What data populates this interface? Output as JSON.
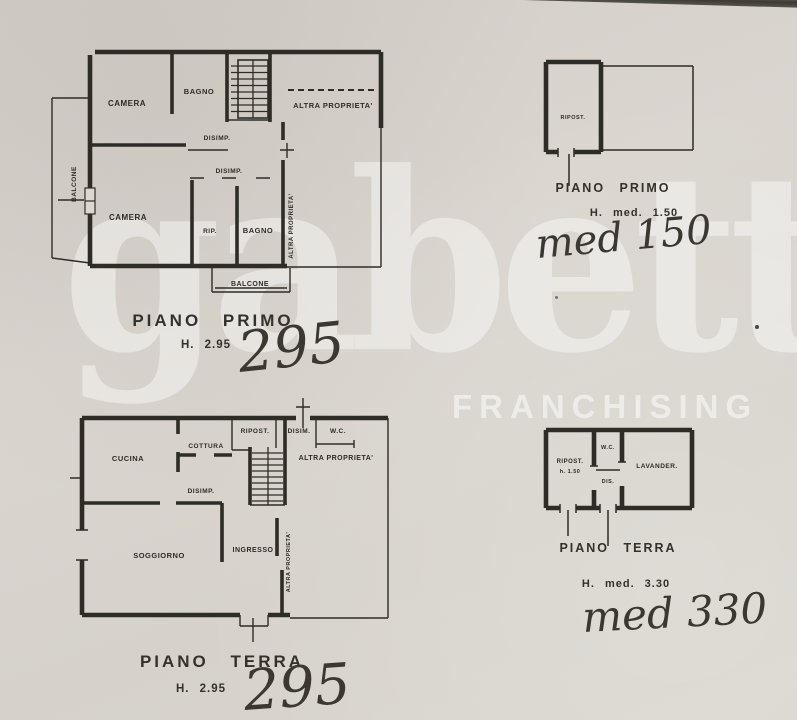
{
  "watermark": {
    "brand": "gabetti",
    "subtitle": "FRANCHISING"
  },
  "plan_piano_primo_main": {
    "rooms": {
      "camera_top": "CAMERA",
      "bagno_top": "BAGNO",
      "altra_proprieta_top": "ALTRA PROPRIETA'",
      "disimp_1": "DISIMP.",
      "disimp_2": "DISIMP.",
      "camera_bottom": "CAMERA",
      "ripostiglio": "RIP.",
      "bagno_bottom": "BAGNO",
      "altra_proprieta_side": "ALTRA PROPRIETA'",
      "balcone_left": "BALCONE",
      "balcone_bottom": "BALCONE"
    },
    "caption_title": "PIANO PRIMO",
    "caption_height": "H. 2.95",
    "handwritten_height": "295"
  },
  "plan_piano_primo_annex": {
    "rooms": {
      "ripostiglio": "RIPOST."
    },
    "caption_title": "PIANO PRIMO",
    "caption_height": "H. med. 1.50",
    "handwritten_height": "med 150"
  },
  "plan_piano_terra_main": {
    "rooms": {
      "cucina": "CUCINA",
      "cottura": "COTTURA",
      "ripostiglio": "RIPOST.",
      "disim": "DISIM.",
      "wc": "W.C.",
      "altra_proprieta_top": "ALTRA PROPRIETA'",
      "disimp": "DISIMP.",
      "soggiorno": "SOGGIORNO",
      "ingresso": "INGRESSO",
      "altra_proprieta_side": "ALTRA PROPRIETA'"
    },
    "caption_title": "PIANO TERRA",
    "caption_height": "H. 2.95",
    "handwritten_height": "295"
  },
  "plan_piano_terra_annex": {
    "rooms": {
      "ripostiglio": "RIPOST.",
      "ripostiglio_height": "h. 1.50",
      "wc": "W.C.",
      "dis": "DIS.",
      "lavanderia": "LAVANDER."
    },
    "caption_title": "PIANO TERRA",
    "caption_height": "H. med. 3.30",
    "handwritten_height": "med 330"
  },
  "colors": {
    "paper": "#d8d4cc",
    "ink": "#2e2c27",
    "watermark_text": "#ffffff"
  }
}
